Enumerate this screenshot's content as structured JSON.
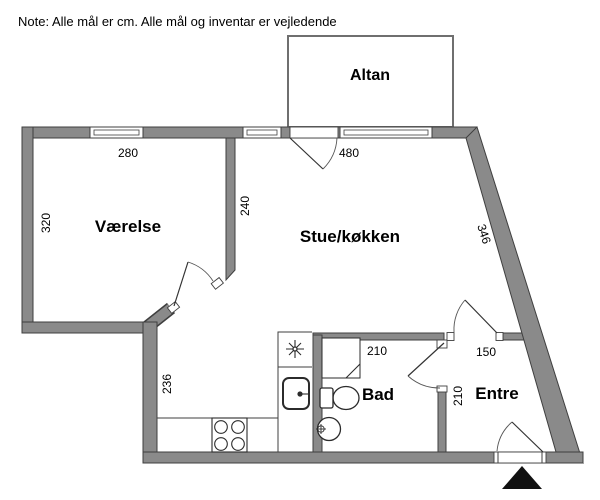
{
  "title_note": "Note: Alle mål er cm. Alle mål og inventar er vejledende",
  "rooms": {
    "altan": "Altan",
    "vaerelse": "Værelse",
    "stue_kokken": "Stue/køkken",
    "bad": "Bad",
    "entre": "Entre"
  },
  "dimensions_cm": {
    "vaerelse_width": "280",
    "vaerelse_depth": "320",
    "stue_left_wall": "240",
    "stue_window_wall": "480",
    "slanted_wall": "346",
    "kitchen_wall": "236",
    "bad_width": "210",
    "entre_top_wall": "150",
    "entre_wall": "210"
  },
  "icons": {
    "north_arrow": "north-arrow-icon",
    "freezer": "freezer-star-icon",
    "stove": "stove-burners-icon",
    "sink": "kitchen-sink-icon",
    "toilet": "toilet-icon",
    "washbasin": "washbasin-icon",
    "shower": "shower-icon"
  },
  "colors": {
    "wall_fill": "#8a8a8a",
    "wall_outline": "#3f3f3f",
    "background": "#ffffff",
    "text": "#000000",
    "thin_line": "#3f3f3f",
    "north_arrow": "#111111"
  }
}
